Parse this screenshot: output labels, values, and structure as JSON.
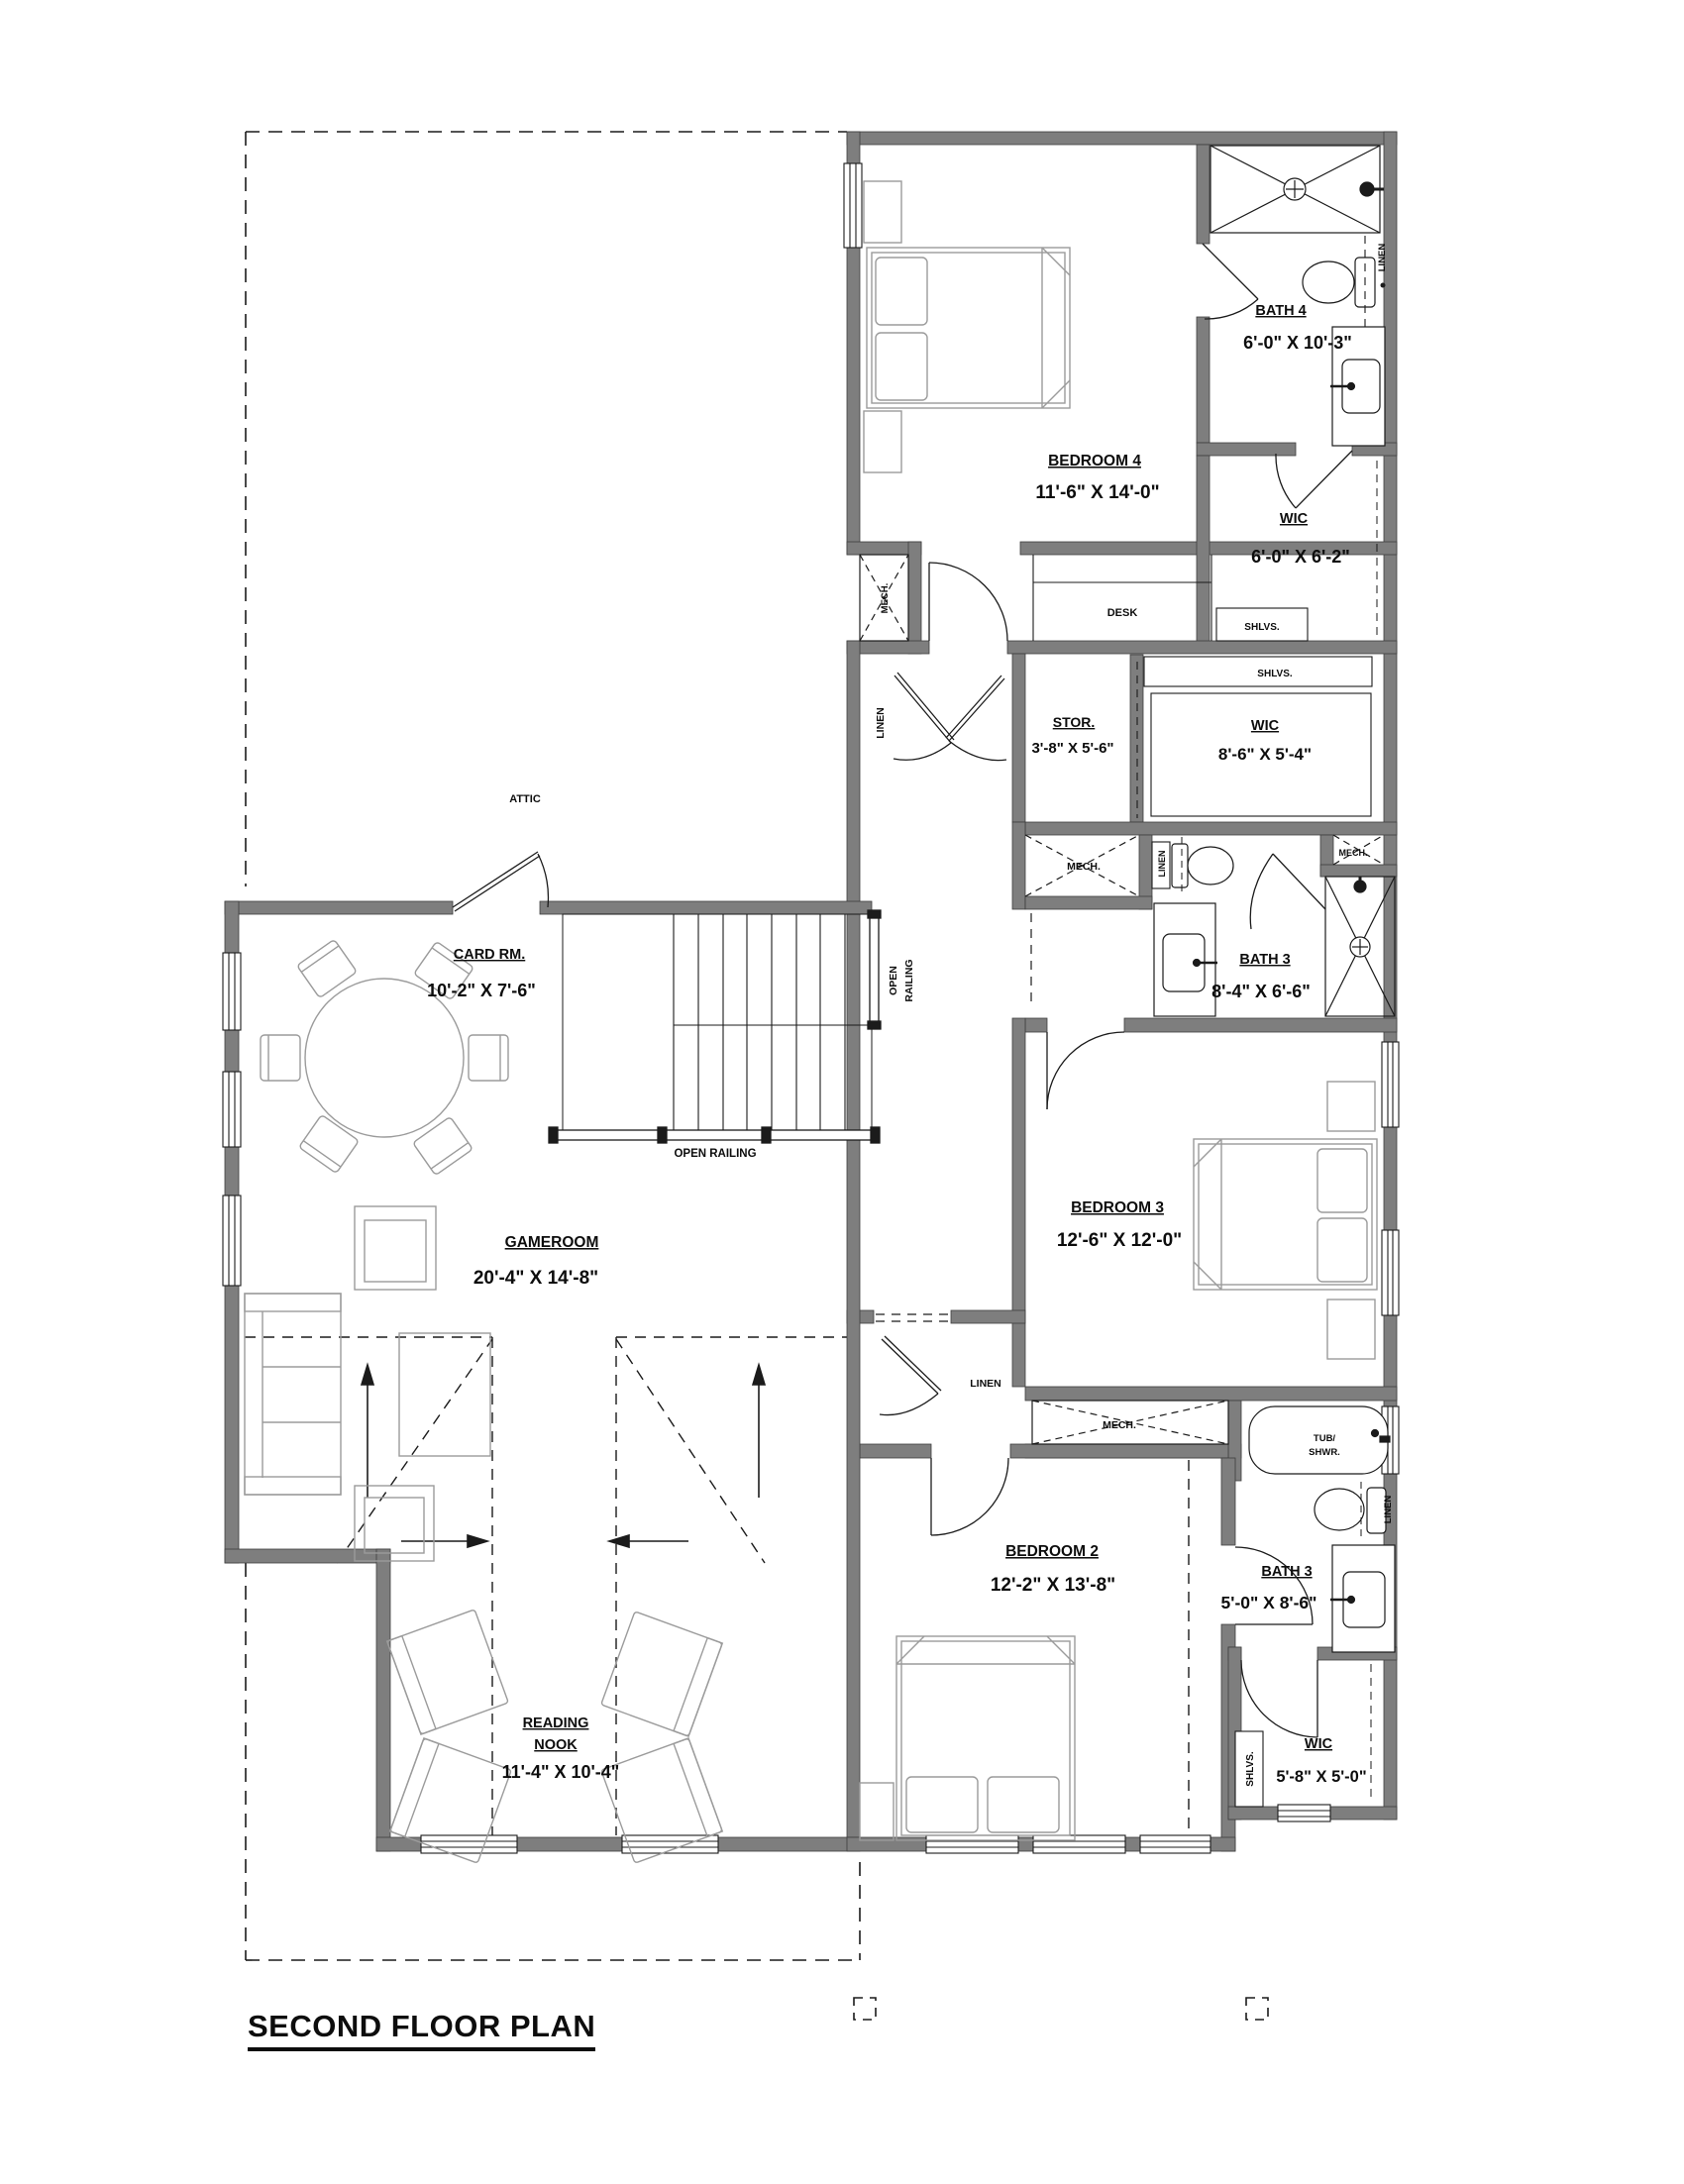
{
  "title": "SECOND FLOOR PLAN",
  "rooms": {
    "bedroom4": {
      "name": "BEDROOM 4",
      "dims": "11'-6\" X 14'-0\""
    },
    "bath4": {
      "name": "BATH 4",
      "dims": "6'-0\" X 10'-3\""
    },
    "wic_bath4": {
      "name": "WIC",
      "dims": "6'-0\" X 6'-2\""
    },
    "stor": {
      "name": "STOR.",
      "dims": "3'-8\" X 5'-6\""
    },
    "wic_hall": {
      "name": "WIC",
      "dims": "8'-6\" X 5'-4\""
    },
    "bath3_hall": {
      "name": "BATH 3",
      "dims": "8'-4\" X 6'-6\""
    },
    "bedroom3": {
      "name": "BEDROOM 3",
      "dims": "12'-6\" X 12'-0\""
    },
    "card_room": {
      "name": "CARD RM.",
      "dims": "10'-2\" X 7'-6\""
    },
    "gameroom": {
      "name": "GAMEROOM",
      "dims": "20'-4\" X 14'-8\""
    },
    "bedroom2": {
      "name": "BEDROOM 2",
      "dims": "12'-2\" X 13'-8\""
    },
    "bath3_bed2": {
      "name": "BATH 3",
      "dims": "5'-0\" X 8'-6\""
    },
    "wic_bed2": {
      "name": "WIC",
      "dims": "5'-8\" X 5'-0\""
    },
    "reading_nook": {
      "name_line1": "READING",
      "name_line2": "NOOK",
      "dims": "11'-4\" X 10'-4\""
    }
  },
  "annotations": {
    "attic": "ATTIC",
    "desk": "DESK",
    "shlvs": "SHLVS.",
    "linen": "LINEN",
    "mech": "MECH.",
    "tub_line1": "TUB/",
    "tub_line2": "SHWR.",
    "open_railing": "OPEN RAILING",
    "open": "OPEN",
    "railing": "RAILING"
  },
  "colors": {
    "wall": "#7e7e7e",
    "line": "#1b1b1b",
    "furniture": "#9b9b9b"
  }
}
